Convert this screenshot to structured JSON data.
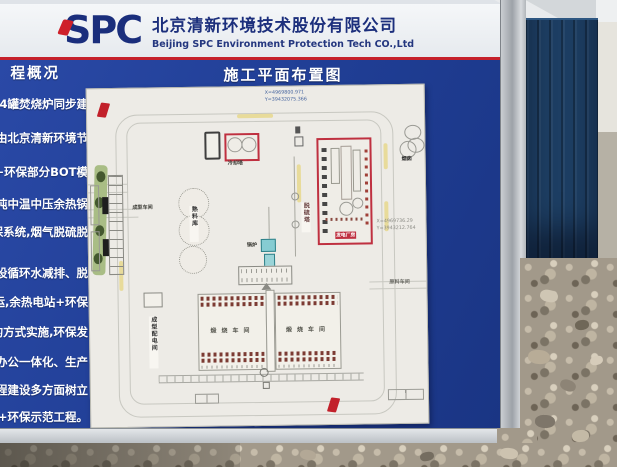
{
  "board": {
    "header": {
      "logo": "SPC",
      "company_cn": "北京清新环境技术股份有限公司",
      "company_en": "Beijing SPC Environment Protection Tech CO.,Ltd"
    },
    "sidebar": {
      "heading": "程概况",
      "lines": [
        "64罐焚烧炉同步建",
        "由北京清新环境节",
        "C+环保部分BOT模",
        "吨中温中压余热锅",
        "保系统,烟气脱硫脱",
        "步建设循环水减排、脱",
        "投运,余热电站+环保",
        "设的方式实施,环保发",
        "生产办公一体化、生产",
        "程、工程建设多方面树立",
        "电+环保示范工程。"
      ]
    },
    "title": "施工平面布置图",
    "plan": {
      "coords_top": {
        "line1": "X=4969800.971",
        "line2": "Y=39432075.366"
      },
      "coords_right": {
        "line1": "X=4969736.29",
        "line2": "Y=3943212.764"
      },
      "labels": {
        "cooling_tower": "冷却塔",
        "desulfurization_tower": "脱硫塔",
        "power_plant_building": "发电厂房",
        "chimney": "烟囱",
        "boiler": "锅炉",
        "forming_workshop": "成型车间",
        "clinker_silo": "熟料库",
        "forming_distribution_room": "成型配电间",
        "calcination_workshop_left": "煅烧车间",
        "calcination_workshop_right": "煅烧车间",
        "raw_material_workshop": "原料车间"
      }
    }
  },
  "colors": {
    "board_blue": "#1f3d93",
    "header_red_line": "#c5202a",
    "logo_navy": "#1a2e7c",
    "plan_paper": "#edebe6",
    "plan_red_outline": "#bf3040",
    "container_blue": "#1d3e63",
    "gravel": "#a2998a"
  }
}
